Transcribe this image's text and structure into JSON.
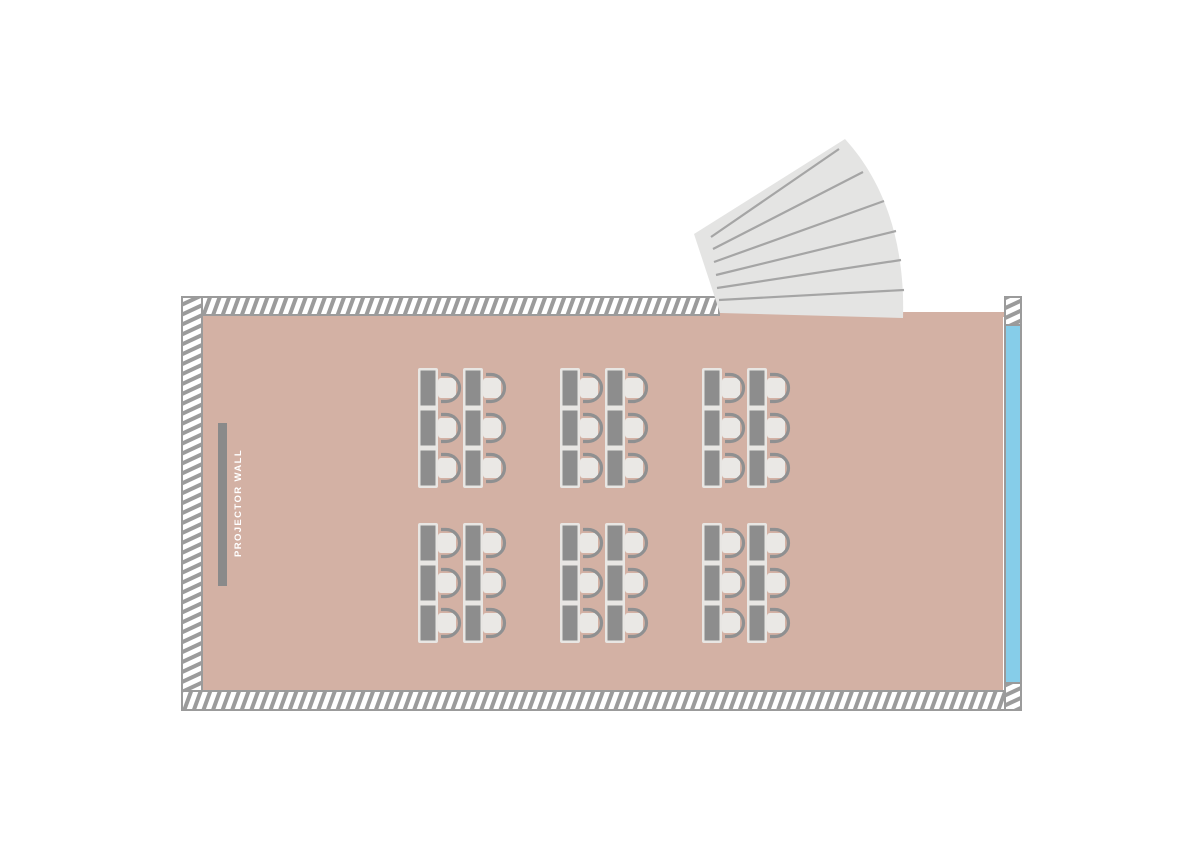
{
  "canvas": {
    "background_color": "#ffffff"
  },
  "room": {
    "floor_color": "#d3b1a4",
    "wall": {
      "hatch_line_color": "#9b9b9b",
      "hatch_bg_color": "#ffffff",
      "border_color": "#9b9b9b"
    }
  },
  "projector_wall": {
    "label": "PROJECTOR WALL",
    "bar_color": "#8a8a8a",
    "label_color": "#ffffff"
  },
  "window": {
    "glass_color": "#86cde9",
    "frame_color": "#9a9a9a"
  },
  "door": {
    "style": "folding-fan",
    "panel_count": 7,
    "fill_color": "#e4e4e3",
    "fold_line_color": "#a5a5a5"
  },
  "furniture": {
    "cluster_grid": {
      "rows": 2,
      "columns": 3
    },
    "cluster": {
      "desk_columns": 2,
      "desks_per_column": 3,
      "chairs_per_desk": 1
    },
    "totals": {
      "clusters": 6,
      "desks": 36,
      "chairs": 36
    },
    "desk_color": "#8d8d8d",
    "desk_frame_color": "#e8e6e3",
    "chair_seat_color": "#eae8e5",
    "chair_back_color": "#8f9091"
  }
}
